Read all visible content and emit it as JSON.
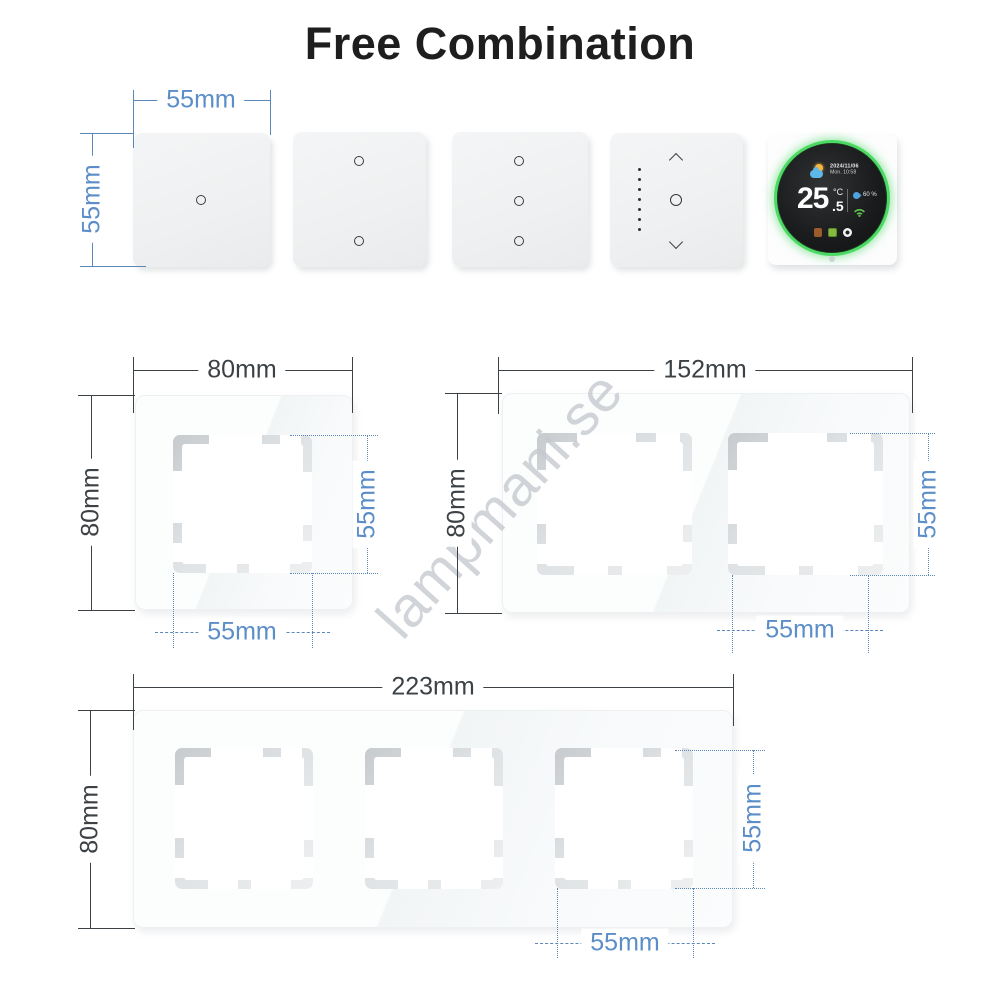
{
  "title": "Free Combination",
  "watermark": "lampmani.se",
  "colors": {
    "dimension_blue": "#5b8ec8",
    "dimension_blue_line": "#5d87b8",
    "dimension_dark": "#3c4145",
    "ring_green": "#4cd964",
    "watermark_gray": "#c6cacf"
  },
  "top_row": {
    "width_label": "55mm",
    "height_label": "55mm"
  },
  "thermostat": {
    "date": "2024/11/06",
    "time": "Mon. 10:58",
    "temperature": "25",
    "unit": "°C",
    "decimal": ".5",
    "humidity": "60 %",
    "icons": [
      "sun-cloud-weather",
      "water-drop-humidity",
      "wifi-signal",
      "heating-mode",
      "eco-mode",
      "power"
    ]
  },
  "frames": {
    "single": {
      "width": "80mm",
      "height": "80mm",
      "inner_width": "55mm",
      "inner_height": "55mm"
    },
    "double": {
      "width": "152mm",
      "height": "80mm",
      "inner_width": "55mm",
      "inner_height": "55mm"
    },
    "triple": {
      "width": "223mm",
      "height": "80mm",
      "inner_width": "55mm",
      "inner_height": "55mm"
    }
  }
}
